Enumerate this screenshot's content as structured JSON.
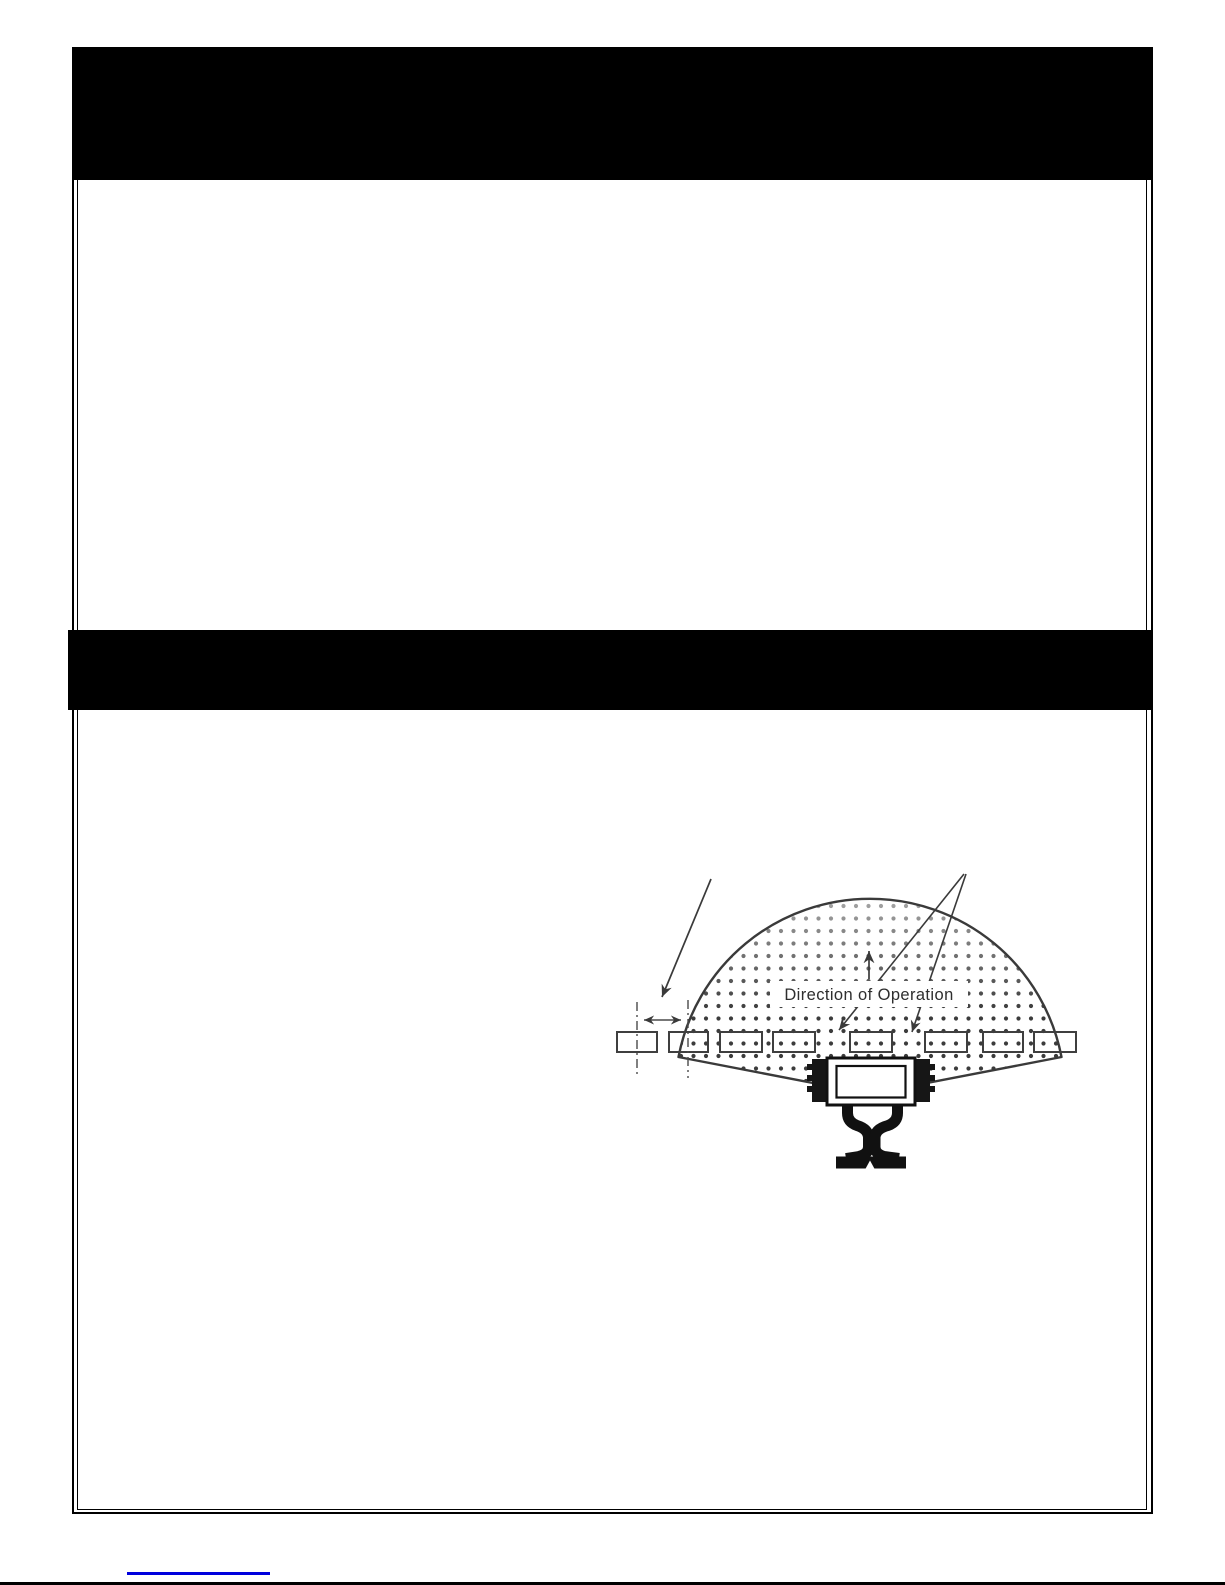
{
  "page": {
    "background": "#ffffff",
    "top_bar_color": "#000000",
    "middle_bar_color": "#000000",
    "footer_link_color": "#0000dd",
    "footer_rule_color": "#000000"
  },
  "figure": {
    "direction_label": "Direction of Operation",
    "ink_color": "#3a3a3a",
    "dot_color": "#3c3c3c",
    "tie_count": 8
  }
}
